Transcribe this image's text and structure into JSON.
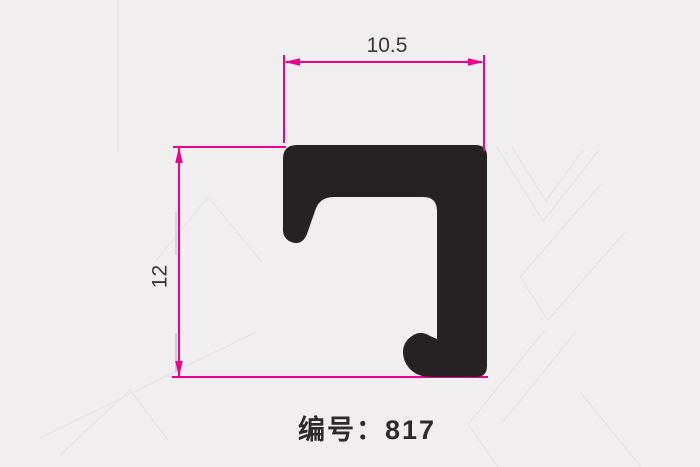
{
  "drawing": {
    "part_number_label": "编号：817",
    "dimensions": {
      "width_value": "10.5",
      "height_value": "12"
    },
    "colors": {
      "dimension_line": "#ec008c",
      "profile_fill": "#262122",
      "background": "#f0eeef",
      "dimension_text": "#383838",
      "part_text": "#2b2b2b",
      "watermark_line": "#e7e4e5"
    }
  }
}
